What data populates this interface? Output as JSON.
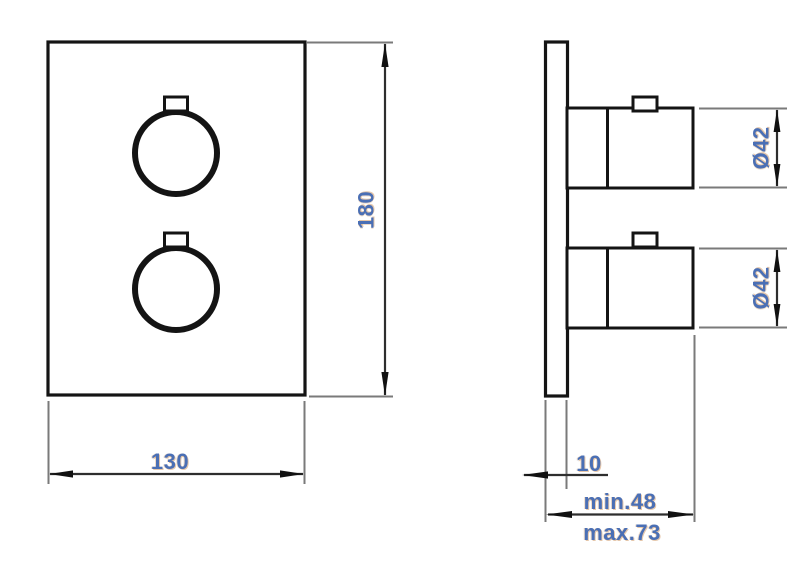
{
  "drawing": {
    "front_view": {
      "width_label": "130",
      "height_label": "180"
    },
    "side_view": {
      "top_knob_diameter_label": "Ø42",
      "bottom_knob_diameter_label": "Ø42",
      "plate_thickness_label": "10",
      "install_depth_min_label": "min.48",
      "install_depth_max_label": "max.73"
    },
    "colors": {
      "object_line": "#141414",
      "dimension_line": "#2e2e2e",
      "extension_line": "#7a7a7a",
      "dimension_text": "#4a6fb5",
      "background": "#ffffff"
    }
  }
}
